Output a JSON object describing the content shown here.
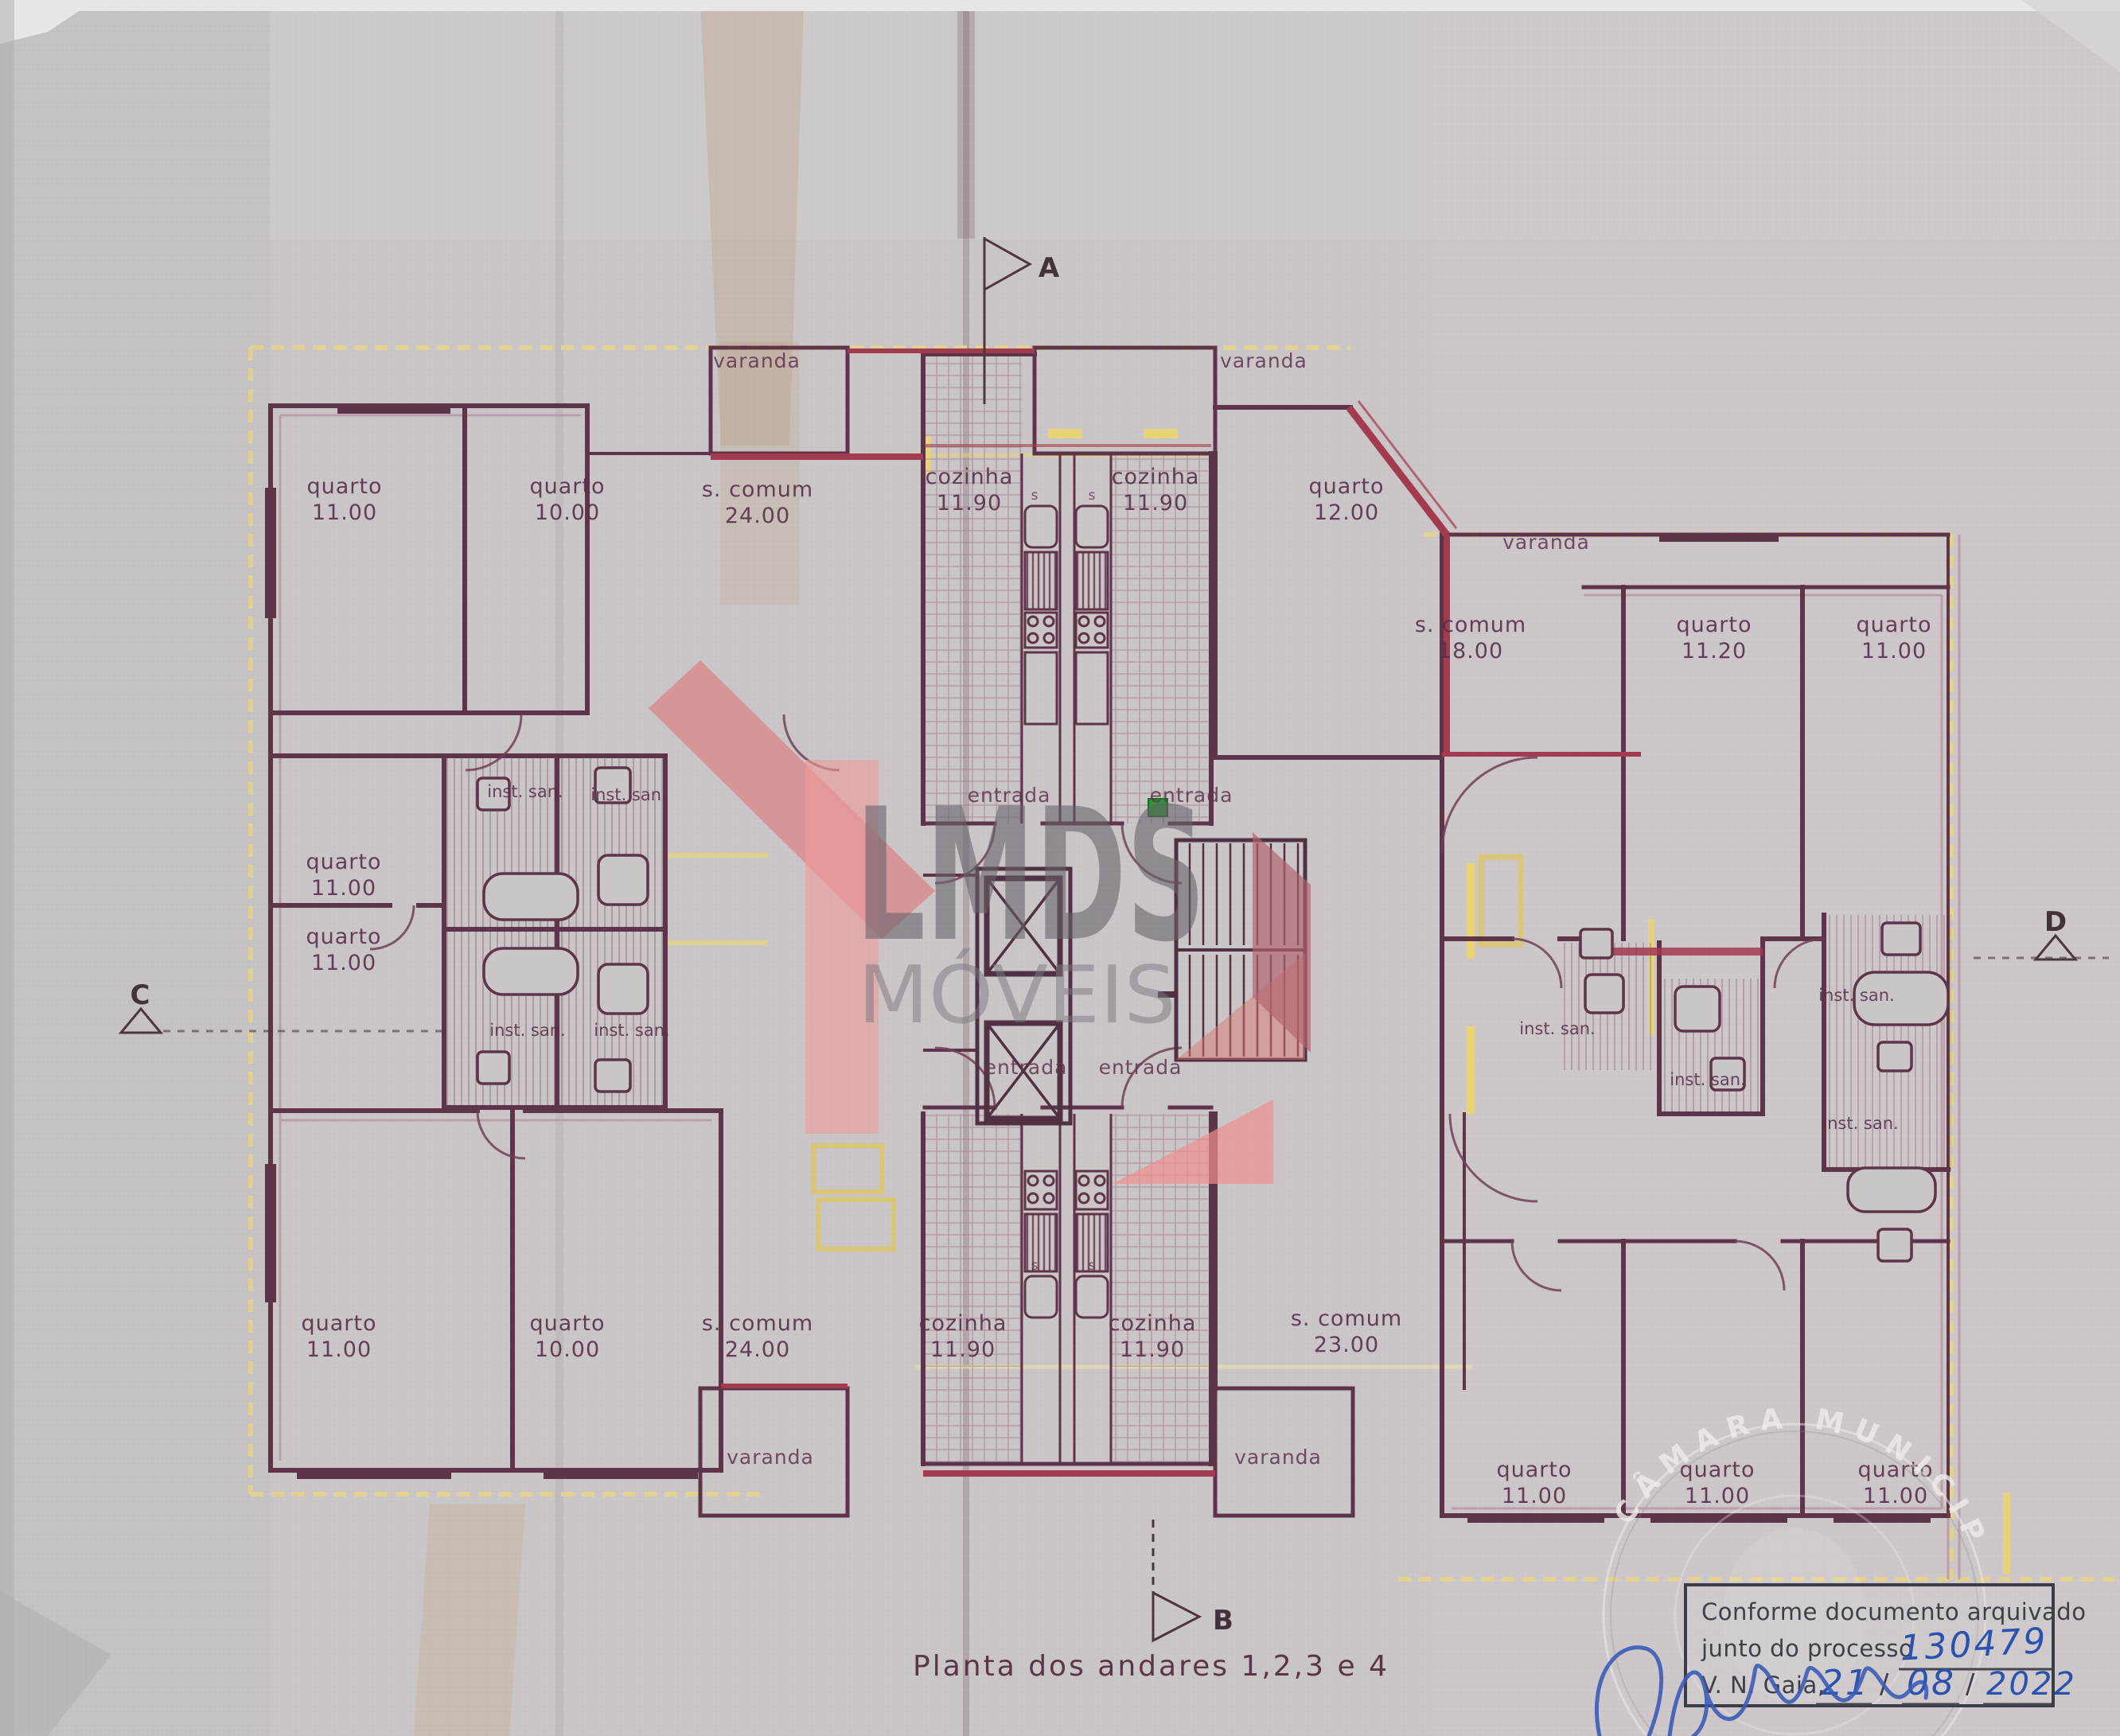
{
  "document": {
    "caption": "Planta dos andares  1,2,3 e 4",
    "paper_color": "#cac5c7",
    "ink_wall_color": "#5e3449",
    "ink_red_color": "#a23a50",
    "highlight_yellow": "#e3d38c",
    "handwriting_blue": "#2a52ae"
  },
  "watermark": {
    "brand": "LMDS",
    "brand_sub": "MÓVEIS"
  },
  "markers": {
    "a": "A",
    "b": "B",
    "c": "C",
    "d": "D"
  },
  "fixture_mark": "s",
  "labels": [
    {
      "t": "varanda"
    },
    {
      "t": "varanda"
    },
    {
      "t": "quarto",
      "a": "11.00"
    },
    {
      "t": "quarto",
      "a": "10.00"
    },
    {
      "t": "s. comum",
      "a": "24.00"
    },
    {
      "t": "cozinha",
      "a": "11.90"
    },
    {
      "t": "cozinha",
      "a": "11.90"
    },
    {
      "t": "quarto",
      "a": "12.00"
    },
    {
      "t": "varanda"
    },
    {
      "t": "s. comum",
      "a": "18.00"
    },
    {
      "t": "quarto",
      "a": "11.20"
    },
    {
      "t": "quarto",
      "a": "11.00"
    },
    {
      "t": "inst. san."
    },
    {
      "t": "inst. san."
    },
    {
      "t": "quarto",
      "a": "11.00"
    },
    {
      "t": "quarto",
      "a": "11.00"
    },
    {
      "t": "inst. san."
    },
    {
      "t": "inst. san."
    },
    {
      "t": "entrada"
    },
    {
      "t": "entrada"
    },
    {
      "t": "entrada"
    },
    {
      "t": "entrada"
    },
    {
      "t": "inst. san."
    },
    {
      "t": "inst. san."
    },
    {
      "t": "inst. san."
    },
    {
      "t": "inst. san."
    },
    {
      "t": "quarto",
      "a": "11.00"
    },
    {
      "t": "quarto",
      "a": "10.00"
    },
    {
      "t": "s. comum",
      "a": "24.00"
    },
    {
      "t": "cozinha",
      "a": "11.90"
    },
    {
      "t": "cozinha",
      "a": "11.90"
    },
    {
      "t": "s. comum",
      "a": "23.00"
    },
    {
      "t": "varanda"
    },
    {
      "t": "varanda"
    },
    {
      "t": "quarto",
      "a": "11.00"
    },
    {
      "t": "quarto",
      "a": "11.00"
    },
    {
      "t": "quarto",
      "a": "11.00"
    }
  ],
  "approval_stamp": {
    "line1": "Conforme documento arquivado",
    "line2_prefix": "junto do processo",
    "process_number": "130479",
    "line3_prefix": "V. N. Gaia,",
    "date_day": "21",
    "date_month": "08",
    "date_year": "2022",
    "slash": "/"
  },
  "embossed_seal": {
    "text": "CÂMARA MUNICIPAL"
  }
}
